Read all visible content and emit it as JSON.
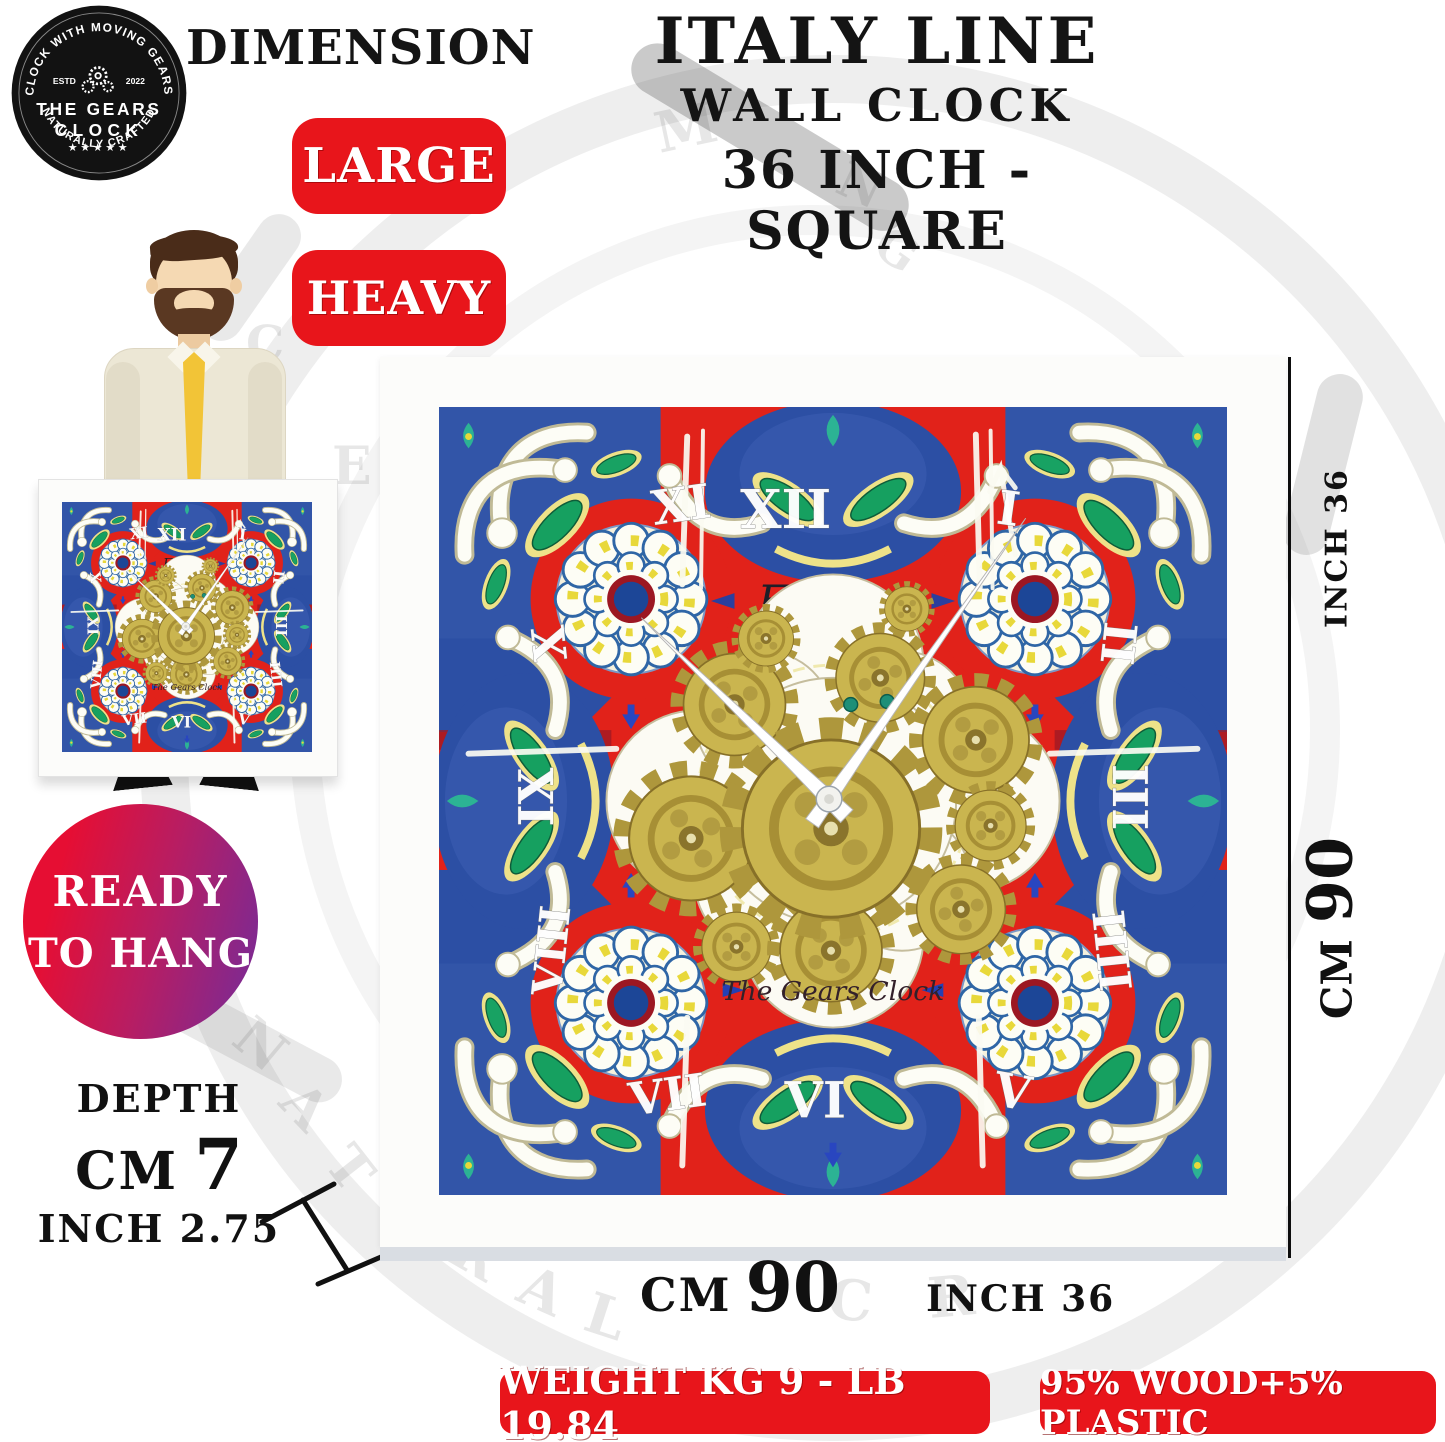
{
  "logo": {
    "arc_top": "CLOCK WITH MOVING GEARS",
    "estd": "ESTD",
    "year": "2022",
    "name1": "THE GEARS",
    "name2": "CLOCK",
    "stars": "★★★★★",
    "arc_bottom": "NATURALLY CRAFTED"
  },
  "header": {
    "dimension": "DIMENSION",
    "size_badge": "LARGE",
    "weight_badge": "HEAVY"
  },
  "title": {
    "line1": "ITALY LINE",
    "line2": "WALL CLOCK",
    "line3": "36 INCH - SQUARE"
  },
  "ready_badge": {
    "line1": "READY",
    "line2": "TO HANG"
  },
  "depth": {
    "label": "DEPTH",
    "cm_unit": "CM",
    "cm_value": "7",
    "inch_unit": "INCH",
    "inch_value": "2.75"
  },
  "clock": {
    "brand": "Furore",
    "maker": "The Gears Clock",
    "numerals": [
      "XII",
      "I",
      "II",
      "III",
      "IIII",
      "V",
      "VI",
      "VII",
      "VIII",
      "IX",
      "X",
      "XI"
    ]
  },
  "measurements": {
    "right_inch": "INCH 36",
    "right_cm_unit": "CM",
    "right_cm_value": "90",
    "bottom_cm_unit": "CM",
    "bottom_cm_value": "90",
    "bottom_inch": "INCH 36"
  },
  "footer": {
    "weight_badge": "WEIGHT KG 9 - LB 19.84",
    "material_badge": "95% WOOD+5% PLASTIC"
  },
  "watermark": {
    "letters": [
      "M",
      "N",
      "G",
      "E",
      "C",
      "N",
      "A",
      "T",
      "R",
      "A",
      "L",
      "C",
      "R"
    ]
  },
  "colors": {
    "badge_red": "#e8151b",
    "clock_red": "#e1221a",
    "clock_blue": "#2c4fa4",
    "leaf_green": "#16a060",
    "gear_gold": "#cab54f",
    "gradient_start": "#e60e33",
    "gradient_end": "#7b2a94"
  }
}
